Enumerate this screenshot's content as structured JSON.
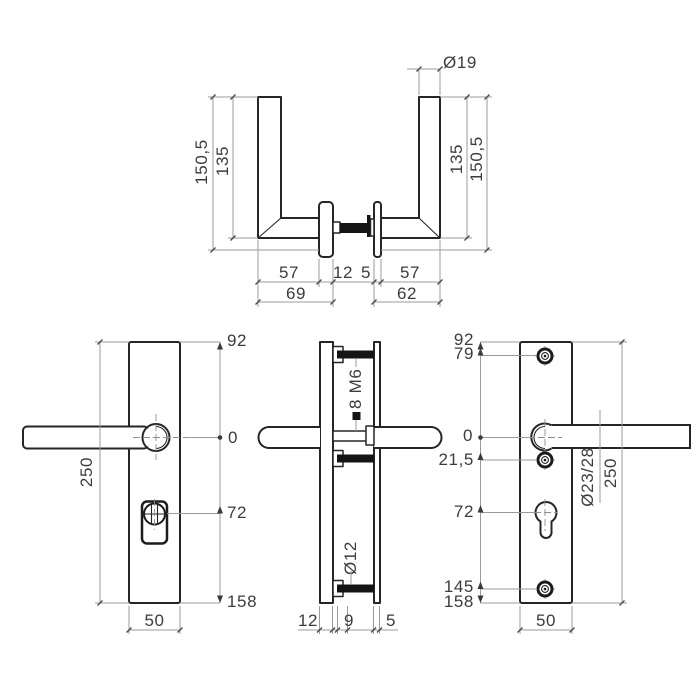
{
  "handle_top_view": {
    "diameter": "Ø19",
    "len_outer_left": "150,5",
    "len_inner_left": "135",
    "len_inner_right": "135",
    "len_outer_right": "150,5",
    "grip_left": "57",
    "rosette_left_thickness": "12",
    "rosette_right_thickness": "5",
    "grip_right": "57",
    "overall_left": "69",
    "overall_right": "62"
  },
  "plate_front_view": {
    "pos_top": "92",
    "pos_zero": "0",
    "pos_cylinder": "72",
    "pos_bottom": "158",
    "height": "250",
    "width": "50"
  },
  "plate_side_view": {
    "bolt": "M6",
    "spindle": "8",
    "bolt_diameter": "Ø12",
    "outer_thickness": "12",
    "boss": "9",
    "inner_thickness": "5"
  },
  "plate_back_view": {
    "pos_top": "92",
    "pos_screw_top": "79",
    "pos_zero": "0",
    "pos_screw_mid": "21,5",
    "pos_cylinder": "72",
    "pos_screw_bottom": "145",
    "pos_bottom": "158",
    "neck_diameter": "Ø23/28",
    "height": "250",
    "width": "50"
  }
}
